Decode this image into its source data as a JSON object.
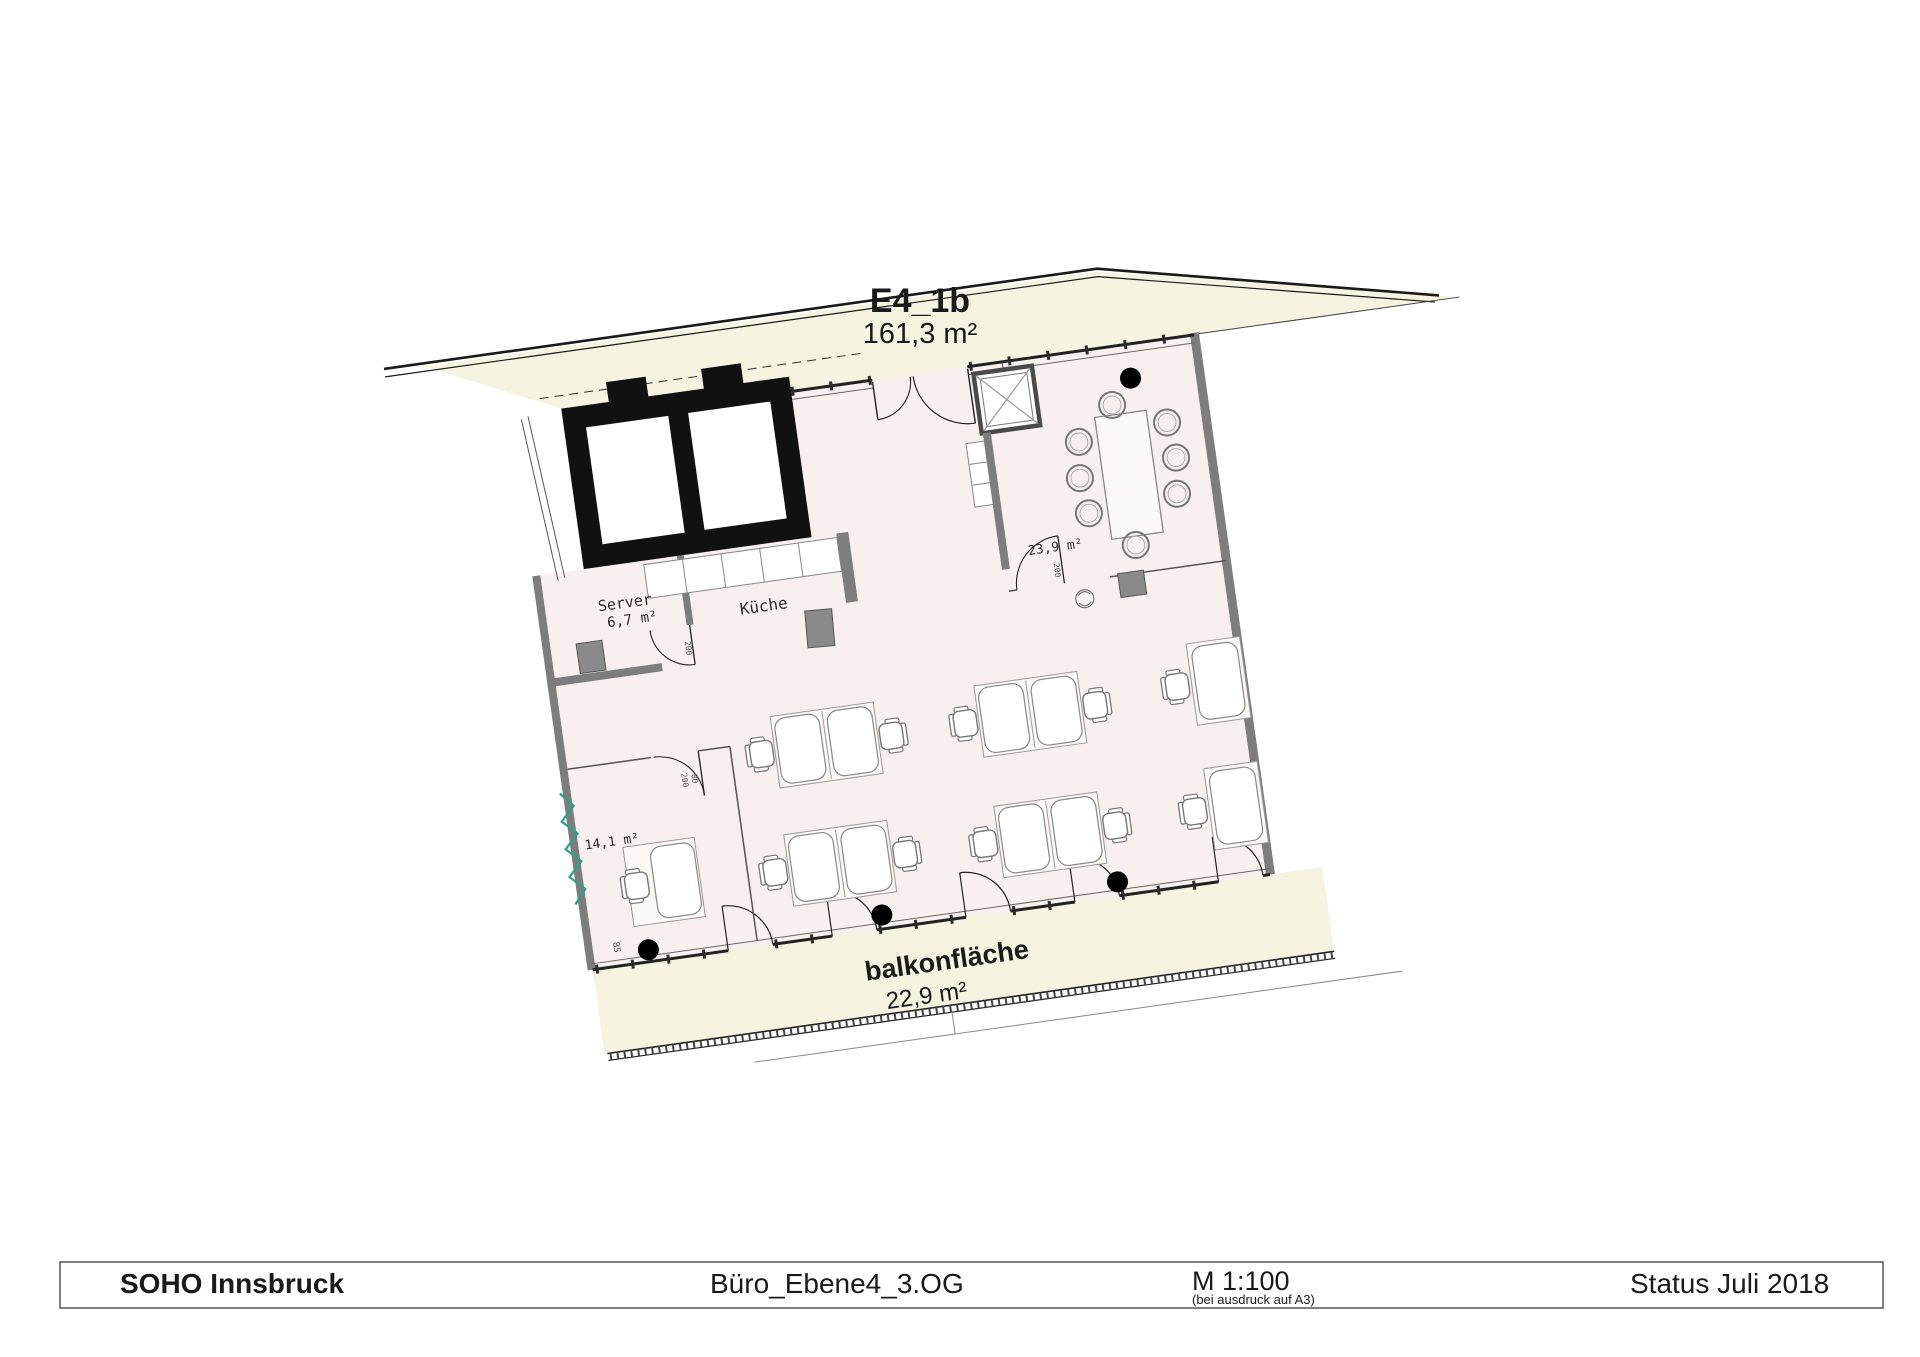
{
  "title": {
    "unit": "E4_1b",
    "area": "161,3 m²"
  },
  "rooms": {
    "server": {
      "name": "Server",
      "area": "6,7 m²"
    },
    "kitchen": {
      "name": "Küche"
    },
    "meeting": {
      "area": "23,9 m²"
    },
    "office_small": {
      "area": "14,1 m²"
    }
  },
  "balcony": {
    "name": "balkonfläche",
    "area": "22,9 m²"
  },
  "dimensions": {
    "door_height": "200",
    "door_width": "80",
    "wall_mark": "85"
  },
  "footer": {
    "project": "SOHO Innsbruck",
    "drawing": "Büro_Ebene4_3.OG",
    "scale": "M 1:100",
    "scale_note": "(bei ausdruck auf A3)",
    "status": "Status Juli 2018"
  },
  "colors": {
    "terrace_cream": "#f6f3e1",
    "floor_pink": "#f8f0ee",
    "wall_gray": "#7d7d7d",
    "line_dark": "#1e1e1e",
    "railing_green": "#2aa189"
  }
}
